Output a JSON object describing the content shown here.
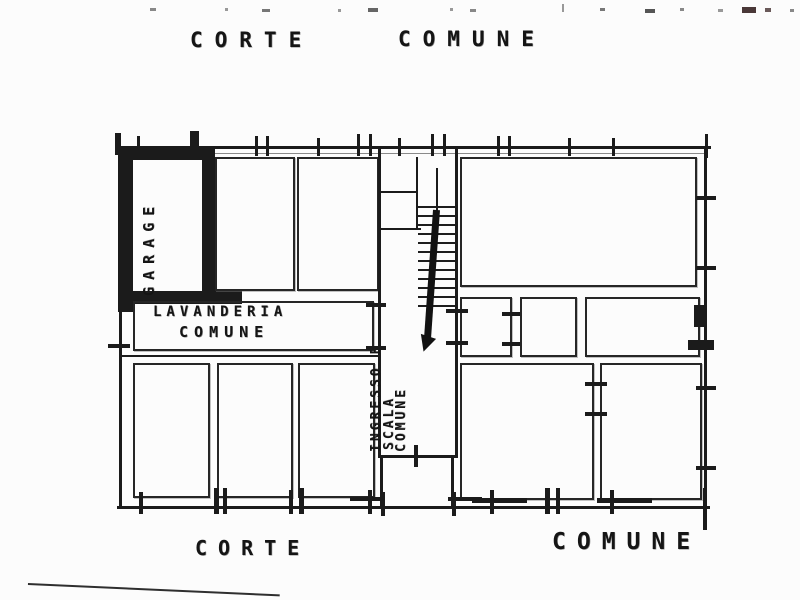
{
  "palette": {
    "ink": "#1b1b1b",
    "paper": "#fcfcfc"
  },
  "labels": {
    "top_courtyard_left_word": "CORTE",
    "top_courtyard_right_word": "COMUNE",
    "bottom_courtyard_left": "CORTE",
    "bottom_courtyard_right": "COMUNE",
    "garage": "GARAGE",
    "laundry_line1": "LAVANDERIA",
    "laundry_line2": "COMUNE",
    "entrance_line1": "INGRESSO E",
    "entrance_line2": "SCALA",
    "entrance_line3": "COMUNE"
  }
}
